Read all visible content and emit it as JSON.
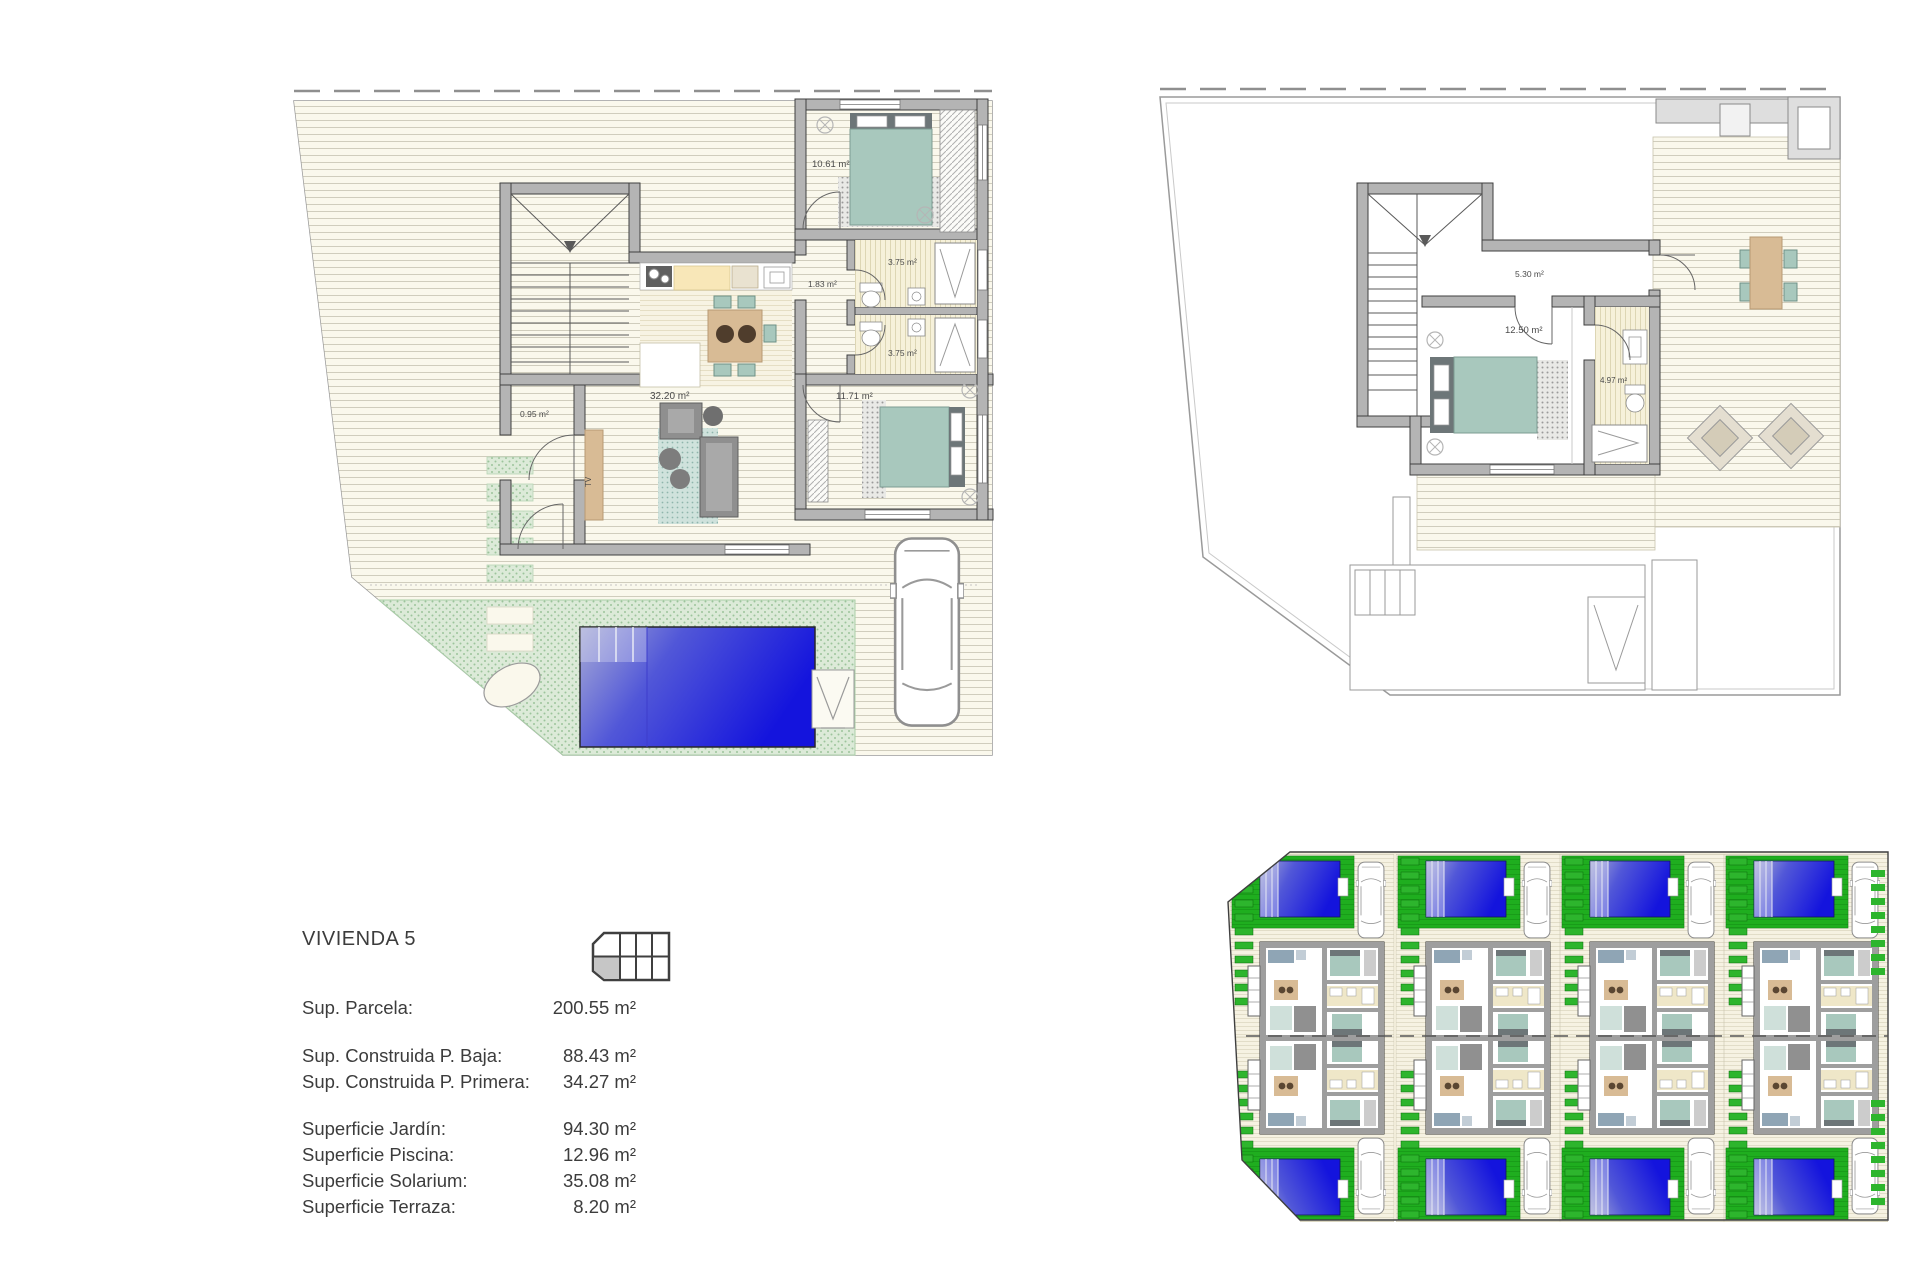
{
  "info_panel": {
    "title": "VIVIENDA 5",
    "groups": [
      {
        "rows": [
          {
            "label": "Sup. Parcela:",
            "value": "200.55 m²"
          }
        ]
      },
      {
        "rows": [
          {
            "label": "Sup. Construida P. Baja:",
            "value": "88.43 m²"
          },
          {
            "label": "Sup. Construida P. Primera:",
            "value": "34.27 m²"
          }
        ]
      },
      {
        "rows": [
          {
            "label": "Superficie Jardín:",
            "value": "94.30 m²"
          },
          {
            "label": "Superficie Piscina:",
            "value": "12.96 m²"
          },
          {
            "label": "Superficie Solarium:",
            "value": "35.08 m²"
          },
          {
            "label": "Superficie Terraza:",
            "value": "8.20 m²"
          }
        ]
      }
    ]
  },
  "ground_floor": {
    "labels": {
      "closet": "0.95 m²",
      "living_kitchen": "32.20 m²",
      "hall": "1.83 m²",
      "bedroom_1": "10.61 m²",
      "bath_1": "3.75 m²",
      "bath_2": "3.75 m²",
      "bedroom_2": "11.71 m²",
      "tv": "TV"
    }
  },
  "first_floor": {
    "labels": {
      "hall": "5.30 m²",
      "bedroom": "12.50 m²",
      "bath": "4.97 m²"
    }
  },
  "site_plan": {
    "columns": 4,
    "rows": 2,
    "total_units": 8
  },
  "colors": {
    "pool_blue_deep": "#1414dd",
    "pool_blue_light": "#a7abd6",
    "garden_green_light": "#dcead8",
    "site_green": "#1fae1f",
    "furniture_teal": "#a8c8bd",
    "headboard_gray": "#6d7678",
    "wood_tan": "#d8bb95",
    "kitchen_yellow": "#f8e7b8",
    "wall_gray": "#b4b4b4",
    "deck_cream": "#faf8ec",
    "line_gray": "#3f3f3f"
  }
}
